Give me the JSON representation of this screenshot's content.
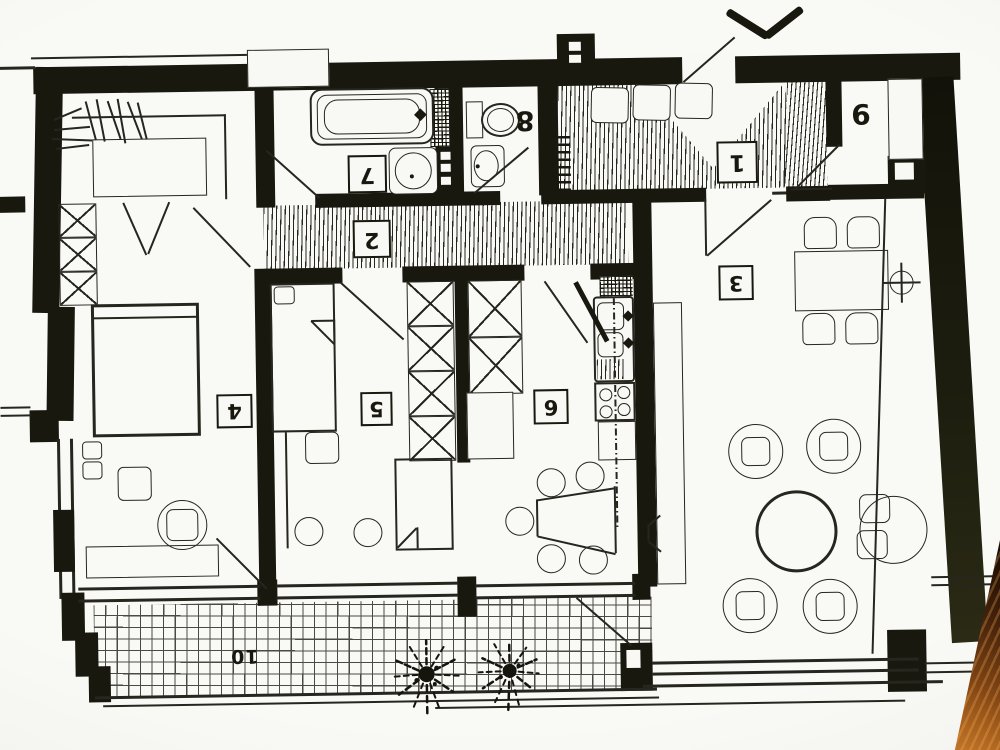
{
  "document": {
    "kind": "scanned architectural floor plan, photographed rotated 180 degrees (room numbers appear upside down)",
    "visible_text_note": "only room numbers 1-10 are printed on the drawing"
  },
  "rooms": [
    {
      "id": "entry-hall",
      "label": "1",
      "label_style": "boxed"
    },
    {
      "id": "corridor",
      "label": "2",
      "label_style": "boxed"
    },
    {
      "id": "living-room",
      "label": "3",
      "label_style": "boxed"
    },
    {
      "id": "bedroom-left",
      "label": "4",
      "label_style": "boxed"
    },
    {
      "id": "bedroom-mid",
      "label": "5",
      "label_style": "boxed"
    },
    {
      "id": "kitchen",
      "label": "6",
      "label_style": "boxed"
    },
    {
      "id": "bathroom",
      "label": "7",
      "label_style": "boxed"
    },
    {
      "id": "wc",
      "label": "8",
      "label_style": "plain"
    },
    {
      "id": "room-topright",
      "label": "9",
      "label_style": "plain"
    },
    {
      "id": "terrace",
      "label": "10",
      "label_style": "plain"
    }
  ],
  "icons": {
    "direction_chevron": "chevron-mark-above-entry-door",
    "riser_symbol": "crosshair-circle",
    "plants": "starburst-plant, two on terrace"
  },
  "colors": {
    "ink": "#18180f",
    "ink2": "#26261f",
    "paper": "#f8f8f4",
    "wood_dark": "#1a0c03",
    "wood_light": "#c1752a"
  }
}
